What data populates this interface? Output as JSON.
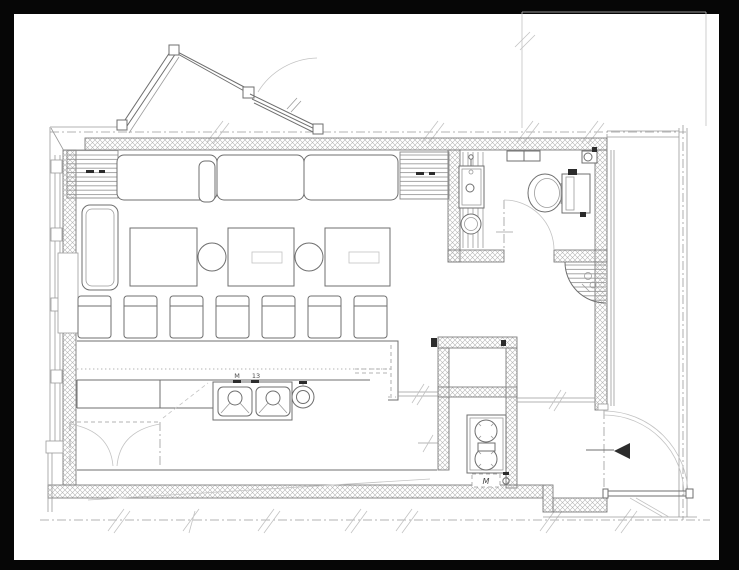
{
  "page": {
    "background": "#000000",
    "paper": "#ffffff"
  },
  "drawing": {
    "type": "architectural-floor-plan",
    "line_color": "#6f6f6f",
    "light_line_color": "#9b9b9b",
    "faint_line_color": "#c3c3c3",
    "wall_hatch_color": "#b4b4b4",
    "marker_color": "#1c1c1c",
    "labels": {
      "sink_faucet_left": "M",
      "sink_faucet_right": "13",
      "gas_meter": "M"
    },
    "counts": {
      "counter_stools": 7,
      "dining_tables": 3,
      "bench_cushions": 3,
      "round_stools": 2,
      "sink_basins": 2,
      "gas_burners": 2
    },
    "elements": [
      "entrance-vestibule",
      "glazed-entry-door",
      "door-swing-arc",
      "bench-seating",
      "dining-tables",
      "round-stools",
      "counter-stools",
      "service-counter",
      "double-sink",
      "hand-wash-sink",
      "under-counter-cabinet-doors",
      "gas-range",
      "gas-meter-box",
      "toilet",
      "toilet-tank",
      "vanity-sink",
      "wash-basin",
      "toilet-door",
      "entrance-door",
      "entrance-marker-triangle",
      "corner-planter",
      "window-wall-mullions",
      "hatched-walls",
      "grid-dashdot-lines",
      "wall-shelf",
      "corner-faucet-fixture",
      "striped-heater-blocks"
    ]
  }
}
